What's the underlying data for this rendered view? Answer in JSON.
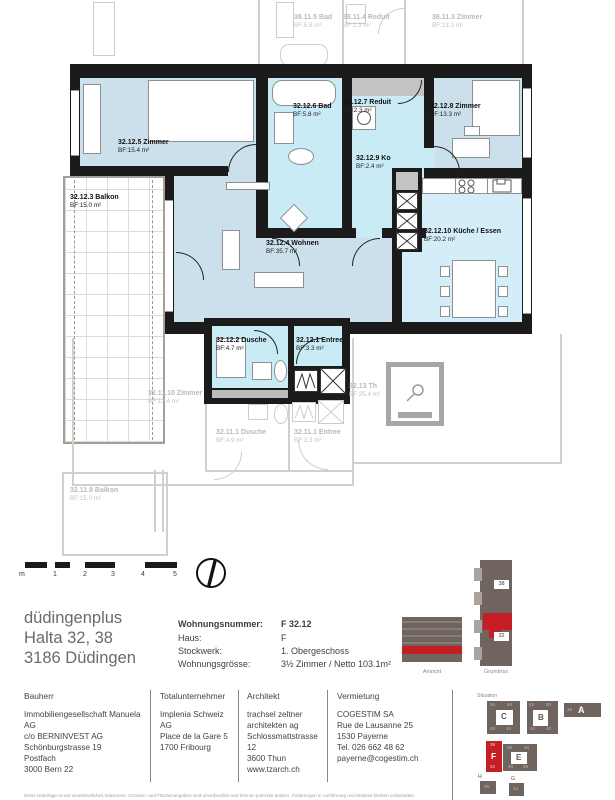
{
  "plan": {
    "rooms": {
      "zimmer5": {
        "name": "32.12.5 Zimmer",
        "area": "BF:15.4 m²"
      },
      "bad6": {
        "name": "32.12.6 Bad",
        "area": "BF:5.8 m²"
      },
      "reduit7": {
        "name": "32.12.7 Reduit",
        "area": "BF:2.3 m²"
      },
      "ko9": {
        "name": "32.12.9 Ko",
        "area": "BF:2.4 m²"
      },
      "zimmer8": {
        "name": "32.12.8 Zimmer",
        "area": "BF:13.3 m²"
      },
      "wohnen4": {
        "name": "32.12.4 Wohnen",
        "area": "BF:35.7 m²"
      },
      "balkon3": {
        "name": "32.12.3 Balkon",
        "area": "BF:15.0 m²"
      },
      "kueche10": {
        "name": "32.12.10 Küche / Essen",
        "area": "BF:20.2 m²"
      },
      "dusche2": {
        "name": "32.12.2 Dusche",
        "area": "BF:4.7 m²"
      },
      "entree1": {
        "name": "32.12.1 Entree",
        "area": "BF:3.3 m²"
      }
    },
    "neighbors": {
      "bad385": {
        "name": "38.11.5 Bad",
        "area": "BF:5.8 m²"
      },
      "reduit384": {
        "name": "38.11.4 Reduit",
        "area": "BF:2.3 m²"
      },
      "zimmer383": {
        "name": "38.11.3 Zimmer",
        "area": "BF:13.3 m²"
      },
      "zimmer3210": {
        "name": "32.11.10 Zimmer",
        "area": "BF:13.4 m²"
      },
      "dusche321": {
        "name": "32.11.1 Dusche",
        "area": "BF:4.9 m²"
      },
      "entree321": {
        "name": "32.11.1 Entree",
        "area": "BF:3.3 m²"
      },
      "th3213": {
        "name": "32.13 Th",
        "area": "BF:25.4 m²"
      },
      "balkon3219": {
        "name": "32.11.9 Balkon",
        "area": "BF:15.0 m²"
      }
    }
  },
  "scalebar": {
    "labels": [
      "m",
      "1",
      "2",
      "3",
      "4",
      "5"
    ]
  },
  "project": {
    "line1": "düdingenplus",
    "line2": "Halta 32, 38",
    "line3": "3186 Düdingen"
  },
  "info": {
    "rows": [
      {
        "label": "Wohnungsnummer:",
        "value": "F 32.12"
      },
      {
        "label": "Haus:",
        "value": "F"
      },
      {
        "label": "Stockwerk:",
        "value": "1. Obergeschoss"
      },
      {
        "label": "Wohnungsgrösse:",
        "value": "3½ Zimmer / Netto 103.1m²"
      }
    ]
  },
  "diagrams": {
    "ansicht": "Ansicht",
    "grundriss": "Grundriss",
    "tags": {
      "top": "38",
      "bottom": "32"
    }
  },
  "contacts": [
    {
      "heading": "Bauherr",
      "lines": [
        "Immobiliengesellschaft Manuela AG",
        "c/o BERNINVEST AG",
        "Schönburgstrasse 19",
        "Postfach",
        "3000 Bern 22"
      ]
    },
    {
      "heading": "Totalunternehmer",
      "lines": [
        "Implenia Schweiz AG",
        "Place de la Gare 5",
        "1700 Fribourg"
      ]
    },
    {
      "heading": "Architekt",
      "lines": [
        "trachsel zeltner",
        "architekten ag",
        "Schlossmattstrasse 12",
        "3600 Thun",
        "www.tzarch.ch"
      ]
    },
    {
      "heading": "Vermietung",
      "lines": [
        "COGESTIM SA",
        "Rue de Lausanne 25",
        "1530 Payerne",
        "Tel. 026 662 48 62",
        "payerne@cogestim.ch"
      ]
    }
  ],
  "situation": {
    "label": "Situation",
    "c": {
      "letter": "C",
      "nums": [
        "56",
        "54",
        "48",
        "44"
      ]
    },
    "b": {
      "letter": "B",
      "nums": [
        "52",
        "50",
        "42",
        "40"
      ]
    },
    "a": {
      "letter": "A",
      "num": "46"
    },
    "f": {
      "letter": "F",
      "top": "38",
      "bottom": "32"
    },
    "e": {
      "letter": "E",
      "nums": [
        "36",
        "34",
        "30",
        "28"
      ]
    },
    "h": {
      "letter": "H",
      "num": "26"
    },
    "g": {
      "letter": "G",
      "num": "24"
    }
  },
  "colors": {
    "accent_red": "#c51f25",
    "building_gray": "#6f655e",
    "room_blue": "#cbe0ea",
    "wet_blue": "#c9ebf6"
  },
  "fineprint": "Diese Unterlage ist ein unverbindliches Dokument. Grössen- und Flächenangaben sind unverbindlich und können jederzeit ändern. Änderungen in Ausführung und Material bleiben vorbehalten."
}
